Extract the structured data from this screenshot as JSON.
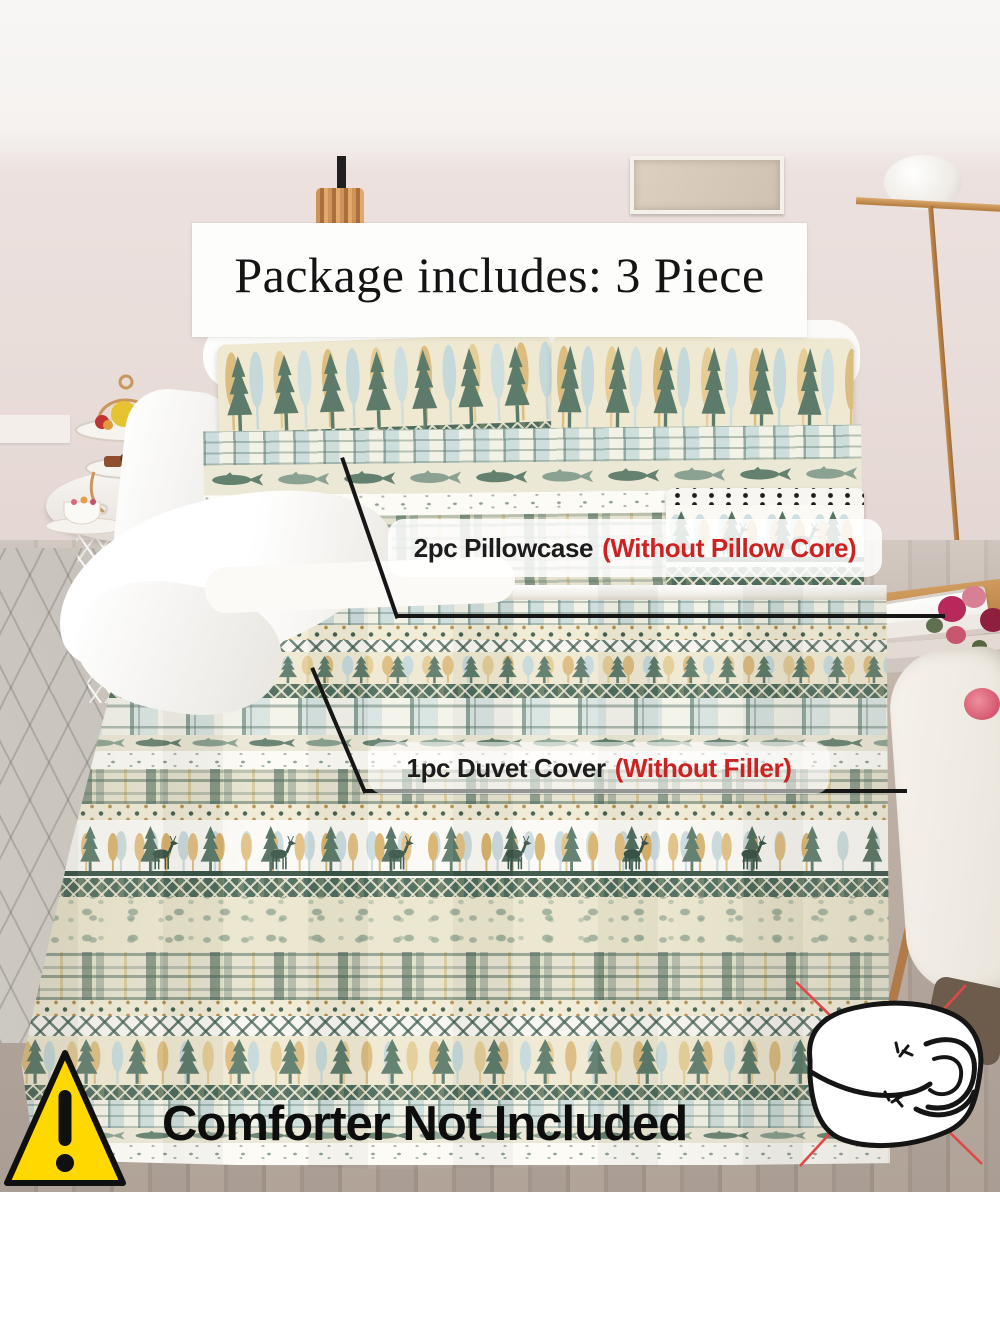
{
  "package_banner": {
    "text": "Package includes: 3 Piece"
  },
  "annotations": {
    "pillowcase": {
      "item": "2pc Pillowcase",
      "note": "(Without Pillow Core)"
    },
    "duvet_cover": {
      "item": "1pc Duvet Cover",
      "note": "(Without Filler)"
    }
  },
  "disclaimer": {
    "text": "Comforter Not Included"
  },
  "icons": {
    "warning": "warning-triangle-icon",
    "no_comforter": "comforter-crossed-out-icon"
  },
  "colors": {
    "annotation_note_red": "#cc2222",
    "warning_yellow": "#ffd800",
    "cross_out_red": "#e04848",
    "leader_line_black": "#161616",
    "duvet_dark_green": "#4d6c5e",
    "duvet_cream": "#ece7d2"
  }
}
